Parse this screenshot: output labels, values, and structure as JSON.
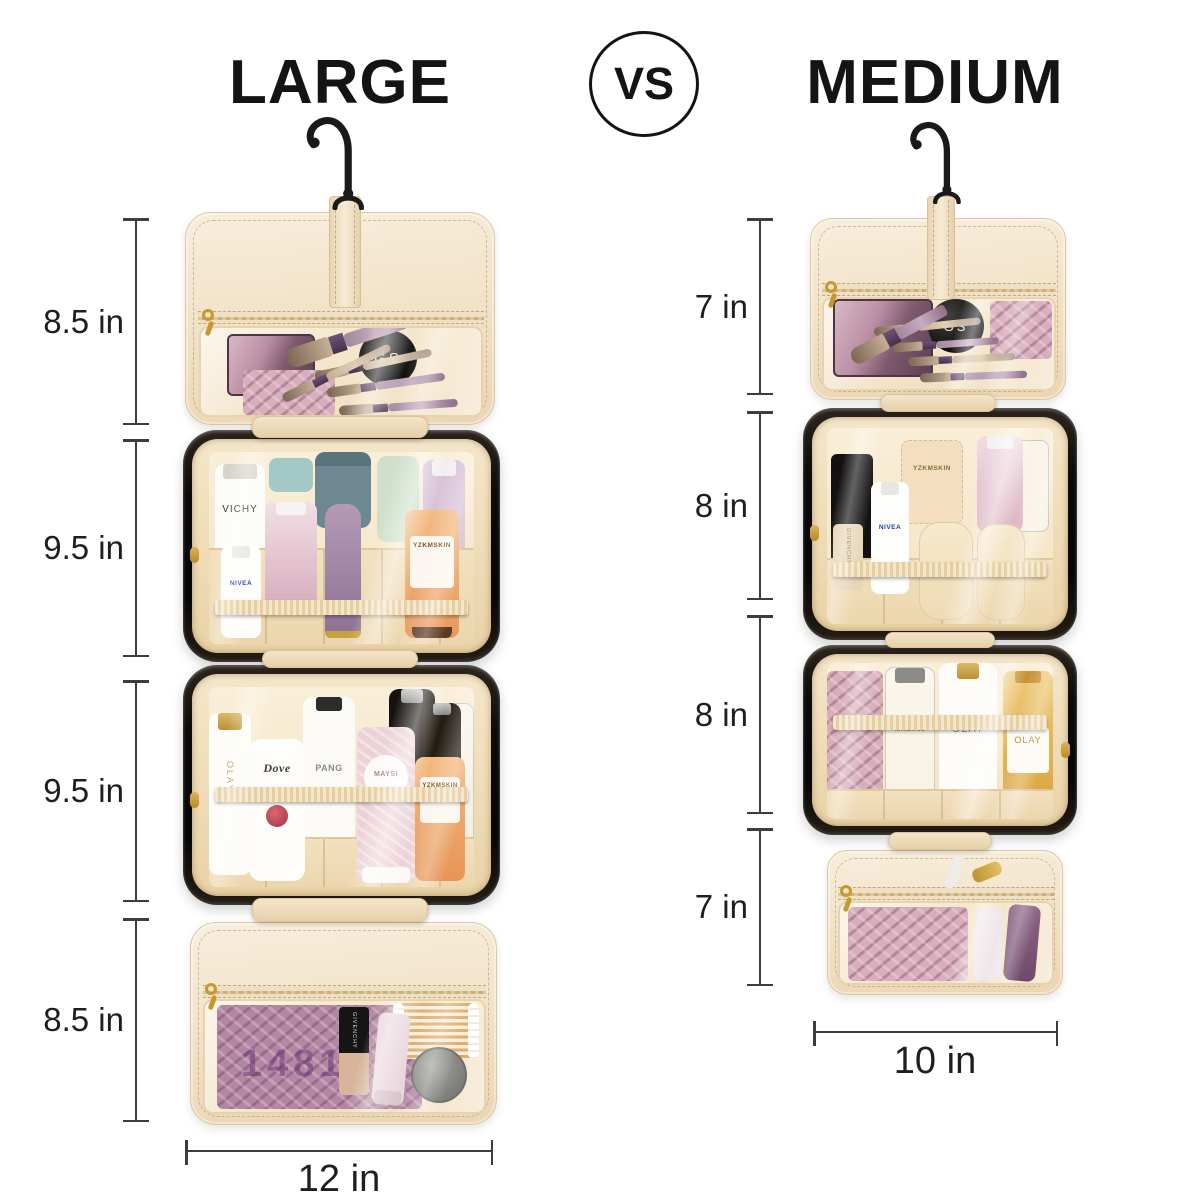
{
  "header": {
    "left_title": "LARGE",
    "vs_label": "VS",
    "right_title": "MEDIUM"
  },
  "palette": {
    "background": "#ffffff",
    "title_text": "#141414",
    "dimension_line": "#3d3d3d",
    "bag_cream": "#f1e0c4",
    "bag_cream_dark": "#e6d0a4",
    "case_black": "#0d0a08",
    "zipper_gold": "#c49a2f",
    "satin": "#f6e9cf"
  },
  "large_bag": {
    "section_dims": [
      "8.5 in",
      "9.5 in",
      "9.5 in",
      "8.5 in"
    ],
    "width_dim": "12 in",
    "products": {
      "compact_glyph": "GS",
      "palette_glyph": "1481",
      "vichy": "VICHY",
      "nivea": "NIVEA",
      "yzkmskin_top": "YZKMSKIN",
      "olay": "OLAY",
      "dove": "Dove",
      "pantene": "PANG",
      "maysi": "MAYSI",
      "yzkmskin_bottom": "YZKMSKIN",
      "givenchy": "GIVENCHY"
    }
  },
  "medium_bag": {
    "section_dims": [
      "7 in",
      "8 in",
      "8 in",
      "7 in"
    ],
    "width_dim": "10 in",
    "products": {
      "compact_glyph": "GS",
      "givenchy": "GIVENCHY",
      "nivea": "NIVEA",
      "yzkmskin": "YZKMSKIN",
      "innisfree": "innisfree",
      "olay_white": "OLAY",
      "olay_gold": "OLAY"
    }
  }
}
